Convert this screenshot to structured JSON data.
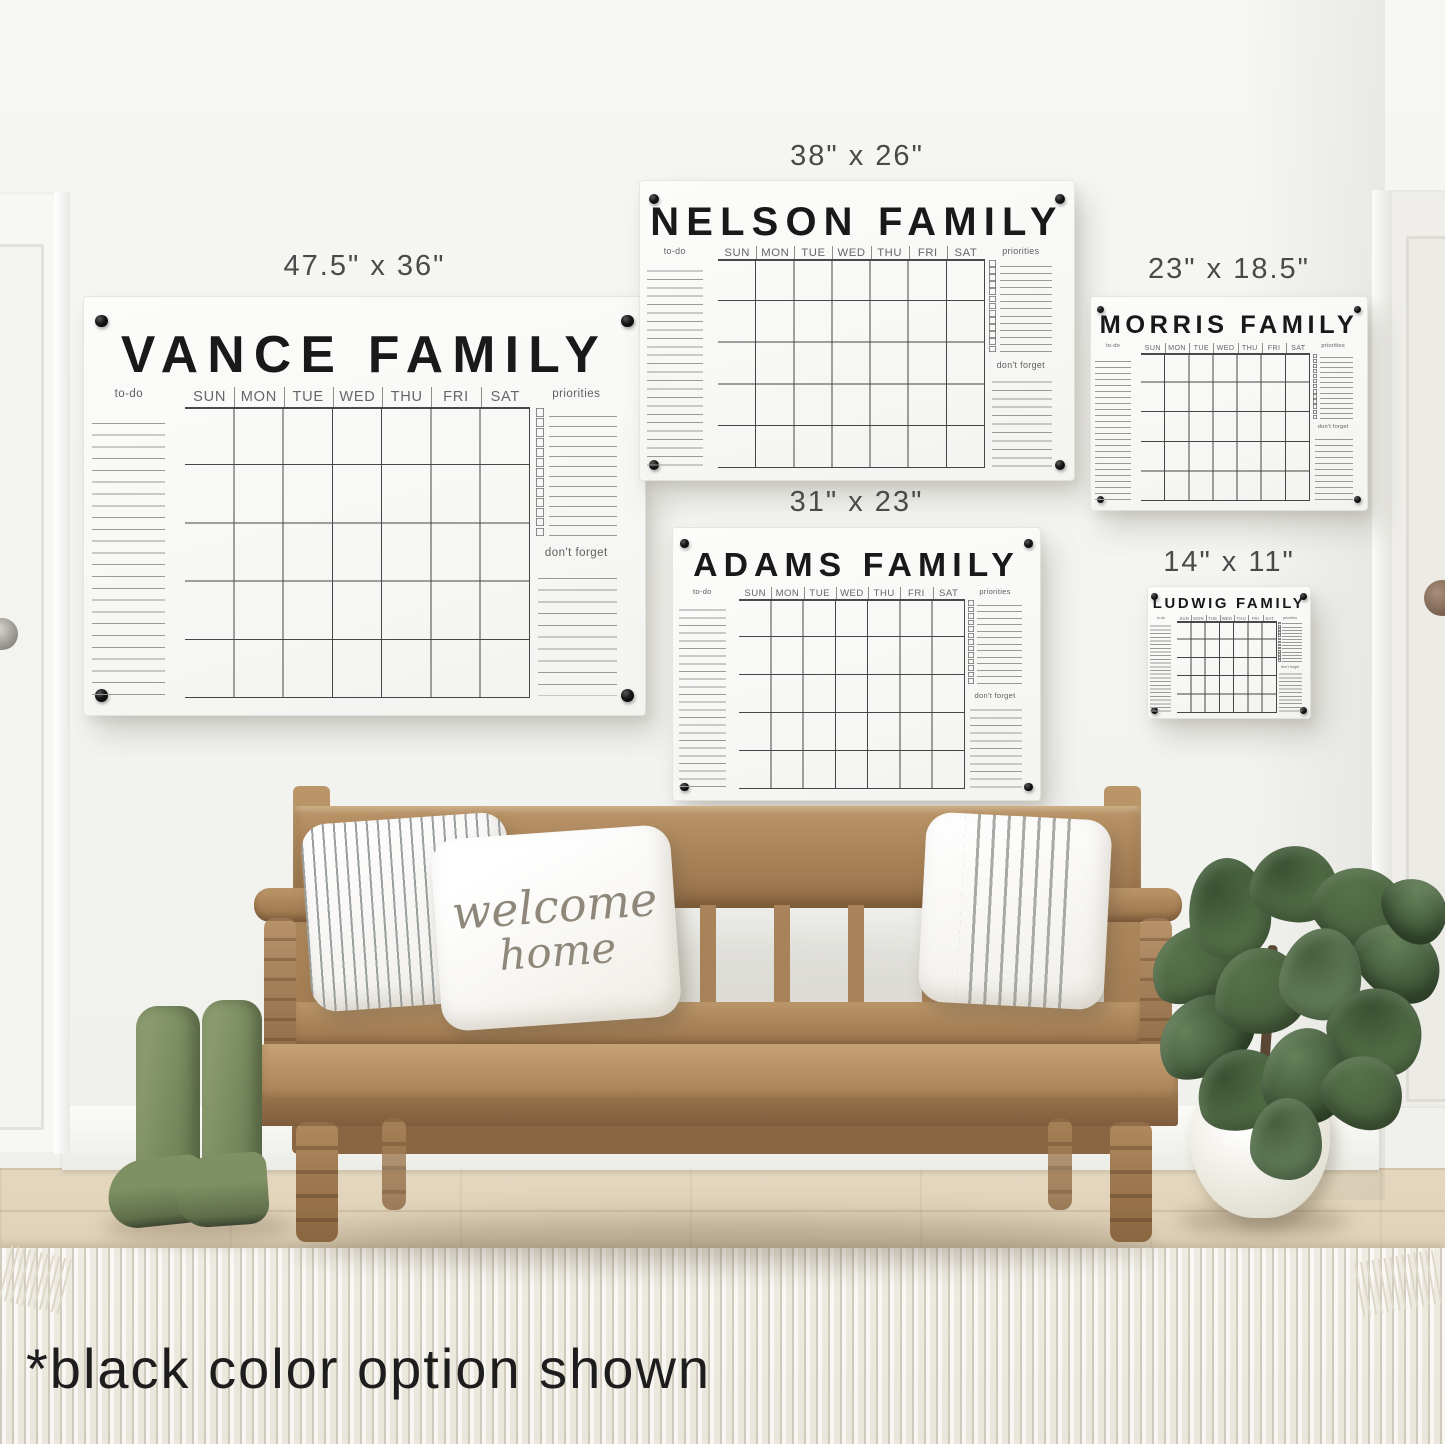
{
  "caption": "*black color option shown",
  "pillows": {
    "welcome_line1": "welcome",
    "welcome_line2": "home"
  },
  "calendar_labels": {
    "todo": "to-do",
    "priorities": "priorities",
    "dont_forget": "don't forget",
    "days": [
      "SUN",
      "MON",
      "TUE",
      "WED",
      "THU",
      "FRI",
      "SAT"
    ]
  },
  "calendars": [
    {
      "name": "vance",
      "title": "VANCE FAMILY",
      "size": "47.5\" x 36\""
    },
    {
      "name": "nelson",
      "title": "NELSON FAMILY",
      "size": "38\" x 26\""
    },
    {
      "name": "adams",
      "title": "ADAMS FAMILY",
      "size": "31\" x 23\""
    },
    {
      "name": "morris",
      "title": "MORRIS FAMILY",
      "size": "23\" x 18.5\""
    },
    {
      "name": "ludwig",
      "title": "LUDWIG FAMILY",
      "size": "14\" x 11\""
    }
  ],
  "colors": {
    "screw": "#111111",
    "board_bg": "#fafaf8",
    "grid_line": "#444745",
    "wood": "#a8835a",
    "boots_green": "#7f9064",
    "leaf_green": "#4c6b42"
  }
}
